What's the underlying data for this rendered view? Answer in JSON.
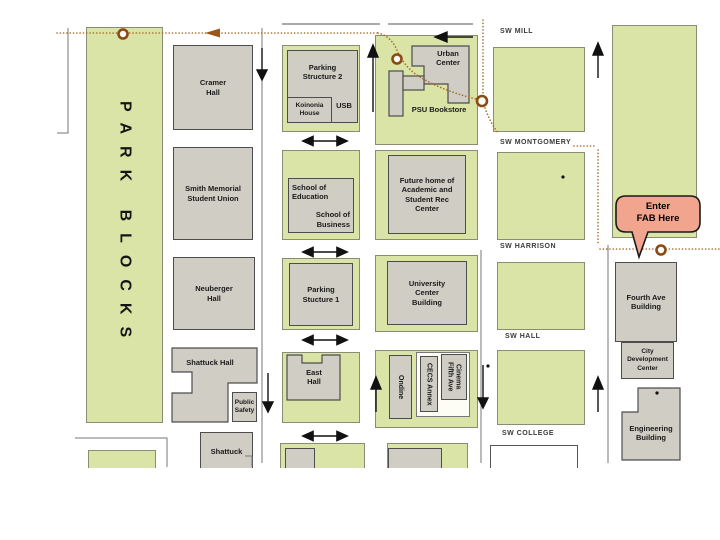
{
  "park": {
    "label": "PARK BLOCKS"
  },
  "streets": {
    "mill": "SW MILL",
    "montgomery": "SW MONTGOMERY",
    "harrison": "SW HARRISON",
    "hall": "SW HALL",
    "college": "SW COLLEGE"
  },
  "buildings": {
    "cramer": "Cramer Hall",
    "smith": "Smith Memorial Student Union",
    "neuberger": "Neuberger Hall",
    "shattuck": "Shattuck Hall",
    "public_safety": "Public Safety",
    "shattuck_south": "Shattuck",
    "parking2": "Parking Structure 2",
    "koinonia": "Koinonia House",
    "usb": "USB",
    "school_of_education": "School of Education",
    "school_of_business": "School of Business",
    "parking1": "Parking Stucture 1",
    "east_hall": "East Hall",
    "urban_center": "Urban Center",
    "psu_bookstore": "PSU Bookstore",
    "future_rec": "Future home of Academic and Student Rec Center",
    "university_center": "University Center Building",
    "ondine": "Ondine",
    "cecs_annex": "CECS Annex",
    "fifth_ave_cinema": {
      "line1": "Fifth Ave",
      "line2": "Cinema"
    },
    "fourth_ave": "Fourth Ave Building",
    "city_dev": "City Development Center",
    "engineering": "Engineering Building"
  },
  "callout": {
    "line1": "Enter",
    "line2": "FAB Here"
  },
  "icons": {
    "entrance_marker": "circle-ring-marker",
    "route_path": "dotted-route-line",
    "one_way": "one-way-arrow",
    "two_way": "two-way-arrow"
  },
  "colors": {
    "block_green": "#D9E4A6",
    "building_gray": "#CFCDC4",
    "route_brown": "#A86B28",
    "marker_ring_brown": "#8B4A12",
    "callout_fill": "#F2A58E",
    "street_line_gray": "#777777",
    "arrow_black": "#111111"
  }
}
